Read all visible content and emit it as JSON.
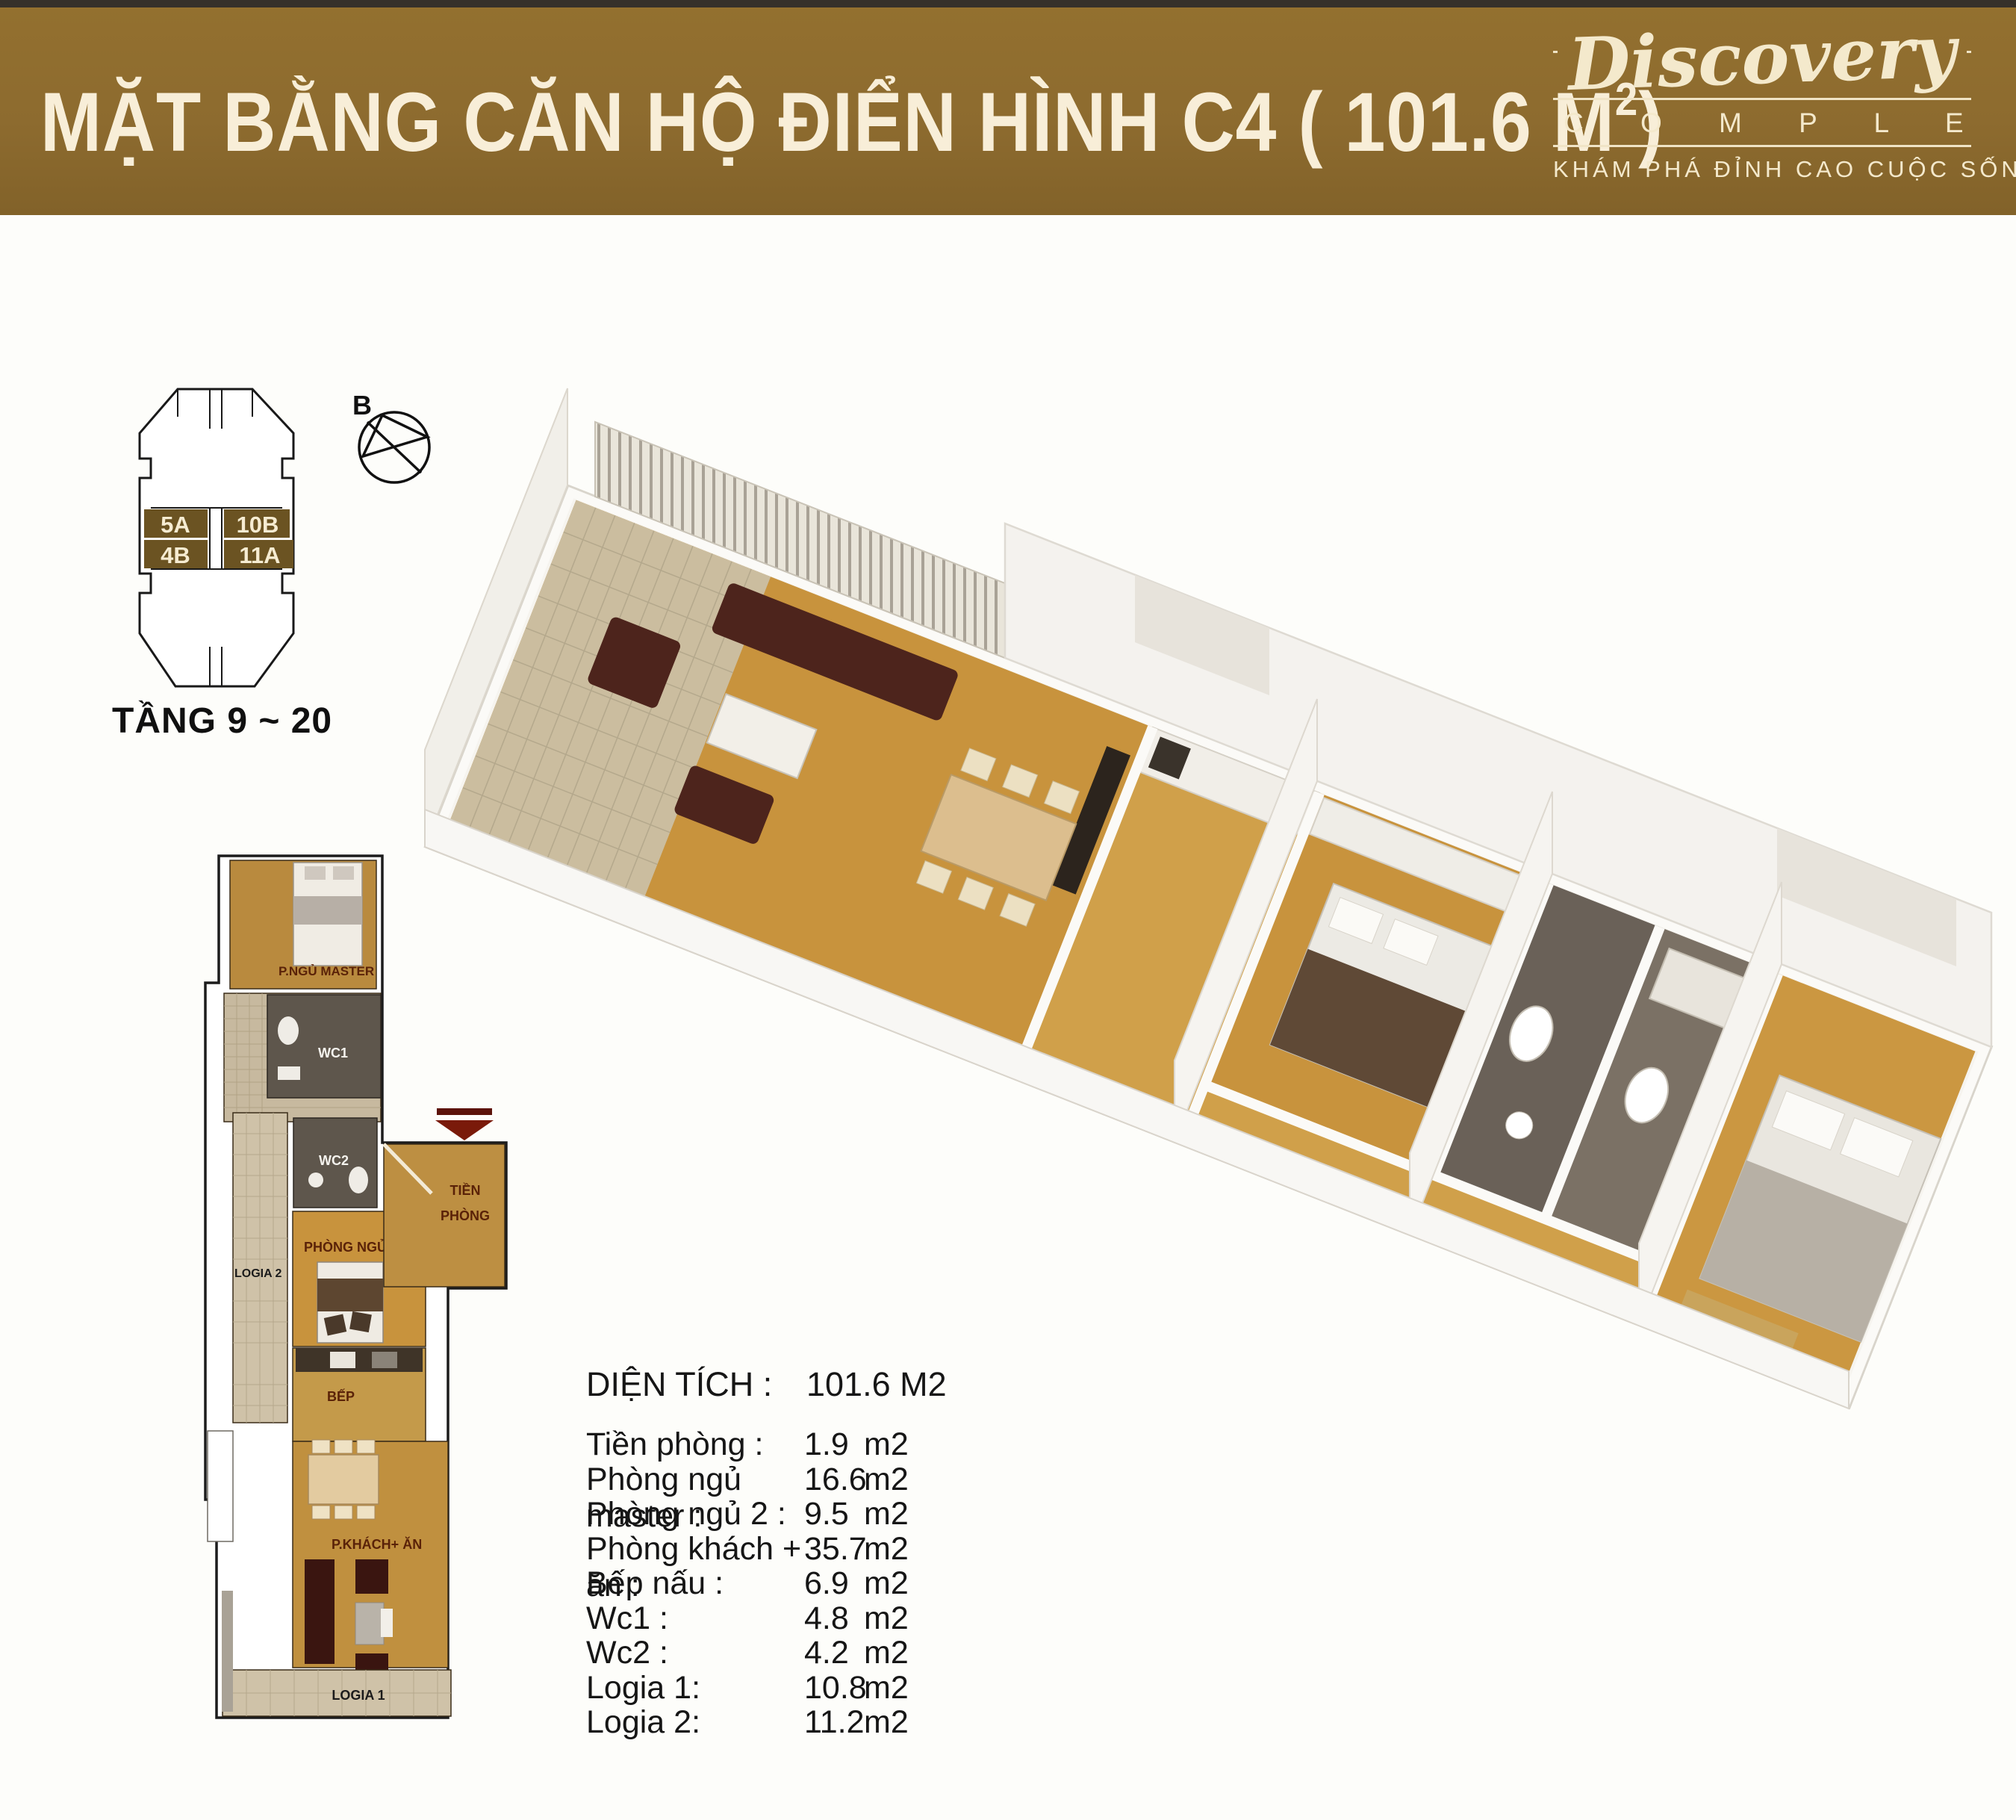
{
  "palette": {
    "banner_gold": "#8d6b2f",
    "banner_text_cream": "#f6ecd4",
    "unit_highlight_brown": "#6b5322",
    "wood_floor": "#c8933d",
    "tile_beige": "#cfc2a8",
    "wc_dark_tile": "#5e564c",
    "room_label_maroon": "#5a2208",
    "entrance_arrow_red": "#5c130a",
    "sofa_dark_brown": "#4d241c"
  },
  "header": {
    "title": "MẶT BẰNG CĂN HỘ ĐIỂN HÌNH C4 ( 101.6 M",
    "title_sup": "2",
    "title_close": ")",
    "logo_script": "Discovery",
    "logo_word": "C O M P L E X",
    "logo_tagline": "KHÁM PHÁ ĐỈNH CAO CUỘC SỐNG"
  },
  "key_plan": {
    "floors_label": "TẦNG 9 ~ 20",
    "compass_label": "B",
    "units": [
      {
        "id": "5A"
      },
      {
        "id": "10B"
      },
      {
        "id": "4B"
      },
      {
        "id": "11A"
      }
    ]
  },
  "floor_plan_2d": {
    "labels": {
      "master": "P.NGỦ MASTER",
      "wc1": "WC1",
      "wc2": "WC2",
      "logia2": "LOGIA 2",
      "tien1": "TIỀN",
      "tien2": "PHÒNG",
      "bedroom2": "PHÒNG NGỦ 2",
      "bep": "BẾP",
      "living": "P.KHÁCH+ ĂN",
      "logia1": "LOGIA 1"
    }
  },
  "area_table": {
    "header_label": "DIỆN TÍCH :",
    "header_value": "101.6 M2",
    "rows": [
      {
        "label": "Tiền phòng :",
        "value": "1.9",
        "unit": "m2"
      },
      {
        "label": "Phòng ngủ master :",
        "value": "16.6",
        "unit": "m2"
      },
      {
        "label": "Phòng ngủ 2 :",
        "value": "9.5",
        "unit": "m2"
      },
      {
        "label": "Phòng khách + ăn :",
        "value": "35.7",
        "unit": "m2"
      },
      {
        "label": "Bếp nấu :",
        "value": "6.9",
        "unit": "m2"
      },
      {
        "label": "Wc1 :",
        "value": "4.8",
        "unit": "m2"
      },
      {
        "label": "Wc2 :",
        "value": "4.2",
        "unit": "m2"
      },
      {
        "label": "Logia 1:",
        "value": "10.8",
        "unit": "m2"
      },
      {
        "label": "Logia 2:",
        "value": "11.2",
        "unit": "m2"
      }
    ]
  }
}
